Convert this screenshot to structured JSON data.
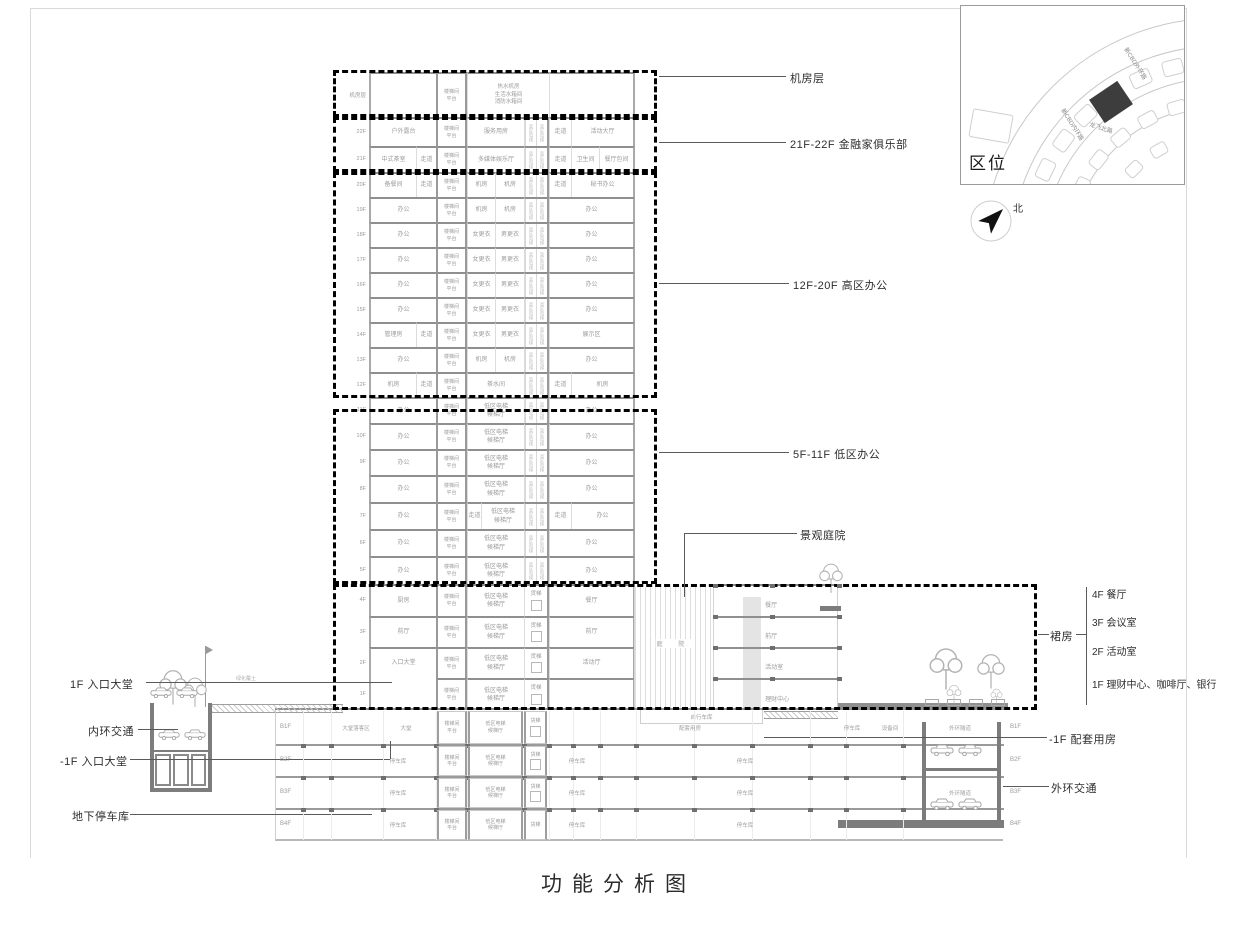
{
  "title": "功能分析图",
  "map": {
    "title": "区位",
    "north": "北",
    "streets": [
      "新CBD外环路",
      "新CBD内环路",
      "龙飞北路"
    ]
  },
  "ann": {
    "machine": "机房层",
    "club": "21F-22F 金融家俱乐部",
    "high": "12F-20F 高区办公",
    "low": "5F-11F 低区办公",
    "courtyard": "景观庭院",
    "podium_group": "裙房",
    "podium_items": [
      "4F 餐厅",
      "3F 会议室",
      "2F 活动室",
      "1F 理财中心、咖啡厅、银行"
    ],
    "b1": "-1F 配套用房",
    "outer_ring": "外环交通",
    "lobby_1f": "1F 入口大堂",
    "inner_ring": "内环交通",
    "lobby_b1": "-1F 入口大堂",
    "garage": "地下停车库"
  },
  "site": {
    "deck": "绿化覆土",
    "courtyard": "庭 院",
    "bike": "自行车库",
    "podium_floors": [
      "餐厅",
      "前厅",
      "活动室",
      "理财中心"
    ]
  },
  "tower": {
    "core": [
      "楼梯间",
      "平台"
    ],
    "shaft_high": "高区电梯",
    "shaft_freight": "货梯",
    "floors": [
      {
        "label": "机房层",
        "wide": "热水机房|生活水箱间|消防水箱间"
      },
      {
        "label": "22F",
        "left": "户外露台",
        "mid": "服务用房",
        "corr": "走道",
        "right": "活动大厅"
      },
      {
        "label": "21F",
        "left": "中式茶室",
        "left2": "走道",
        "mid": "多媒体娱乐厅",
        "corr": "走道",
        "right": "卫生间",
        "right2": "餐厅包间"
      },
      {
        "label": "20F",
        "left": "备餐间",
        "left2": "走道",
        "mid": "机房",
        "mid2": "机房",
        "corr": "走道",
        "right": "秘书办公"
      },
      {
        "label": "19F",
        "left": "办公",
        "mid": "机房",
        "mid2": "机房",
        "right": "办公"
      },
      {
        "label": "18F",
        "left": "办公",
        "mid": "女更衣",
        "mid2": "男更衣",
        "right": "办公"
      },
      {
        "label": "17F",
        "left": "办公",
        "mid": "女更衣",
        "mid2": "男更衣",
        "right": "办公"
      },
      {
        "label": "16F",
        "left": "办公",
        "mid": "女更衣",
        "mid2": "男更衣",
        "right": "办公"
      },
      {
        "label": "15F",
        "left": "办公",
        "mid": "女更衣",
        "mid2": "男更衣",
        "right": "办公"
      },
      {
        "label": "14F",
        "left": "管理房",
        "left2": "走道",
        "mid": "女更衣",
        "mid2": "男更衣",
        "right": "展示区"
      },
      {
        "label": "13F",
        "left": "办公",
        "mid": "机房",
        "mid2": "机房",
        "right": "办公"
      },
      {
        "label": "12F",
        "left": "机房",
        "left2": "走道",
        "mid": "茶水间",
        "corr": "走道",
        "right": "机房"
      },
      {
        "label": "11F",
        "left": "办公",
        "mid": "低区电梯|候梯厅",
        "right": "办公"
      },
      {
        "label": "10F",
        "left": "办公",
        "mid": "低区电梯|候梯厅",
        "right": "办公"
      },
      {
        "label": "9F",
        "left": "办公",
        "mid": "低区电梯|候梯厅",
        "right": "办公"
      },
      {
        "label": "8F",
        "left": "办公",
        "mid": "低区电梯|候梯厅",
        "right": "办公"
      },
      {
        "label": "7F",
        "left": "办公",
        "corrL": "走道",
        "mid": "低区电梯|候梯厅",
        "corr": "走道",
        "right": "办公"
      },
      {
        "label": "6F",
        "left": "办公",
        "mid": "低区电梯|候梯厅",
        "right": "办公"
      },
      {
        "label": "5F",
        "left": "办公",
        "mid": "低区电梯|候梯厅",
        "right": "办公"
      },
      {
        "label": "4F",
        "left": "厨房",
        "mid": "低区电梯|候梯厅",
        "shaft": "freight",
        "right": "餐厅"
      },
      {
        "label": "3F",
        "left": "前厅",
        "mid": "低区电梯|候梯厅",
        "shaft": "freight",
        "right": "前厅"
      },
      {
        "label": "2F",
        "left": "入口大堂",
        "mid": "低区电梯|候梯厅",
        "shaft": "freight",
        "right": "活动厅"
      },
      {
        "label": "1F",
        "left": "",
        "lobbyOpen": true,
        "mid": "低区电梯|候梯厅",
        "shaft": "freight",
        "right": ""
      }
    ]
  },
  "basement": {
    "labels_left": [
      "B1F",
      "B2F",
      "B3F",
      "B4F"
    ],
    "labels_right": [
      "B1F",
      "B2F",
      "B3F",
      "B4F"
    ],
    "core": {
      "stair": "楼梯间|平台",
      "lobby": "低区电梯|候梯厅",
      "freight": "货梯"
    },
    "rows": [
      [
        "大堂落客区",
        "大堂",
        "配套用房",
        "停车库",
        "设备间",
        "外环隧道"
      ],
      [
        "停车库",
        "停车库",
        "停车库"
      ],
      [
        "停车库",
        "停车库",
        "停车库",
        "外环隧道"
      ],
      [
        "停车库",
        "停车库",
        "停车库"
      ]
    ]
  }
}
